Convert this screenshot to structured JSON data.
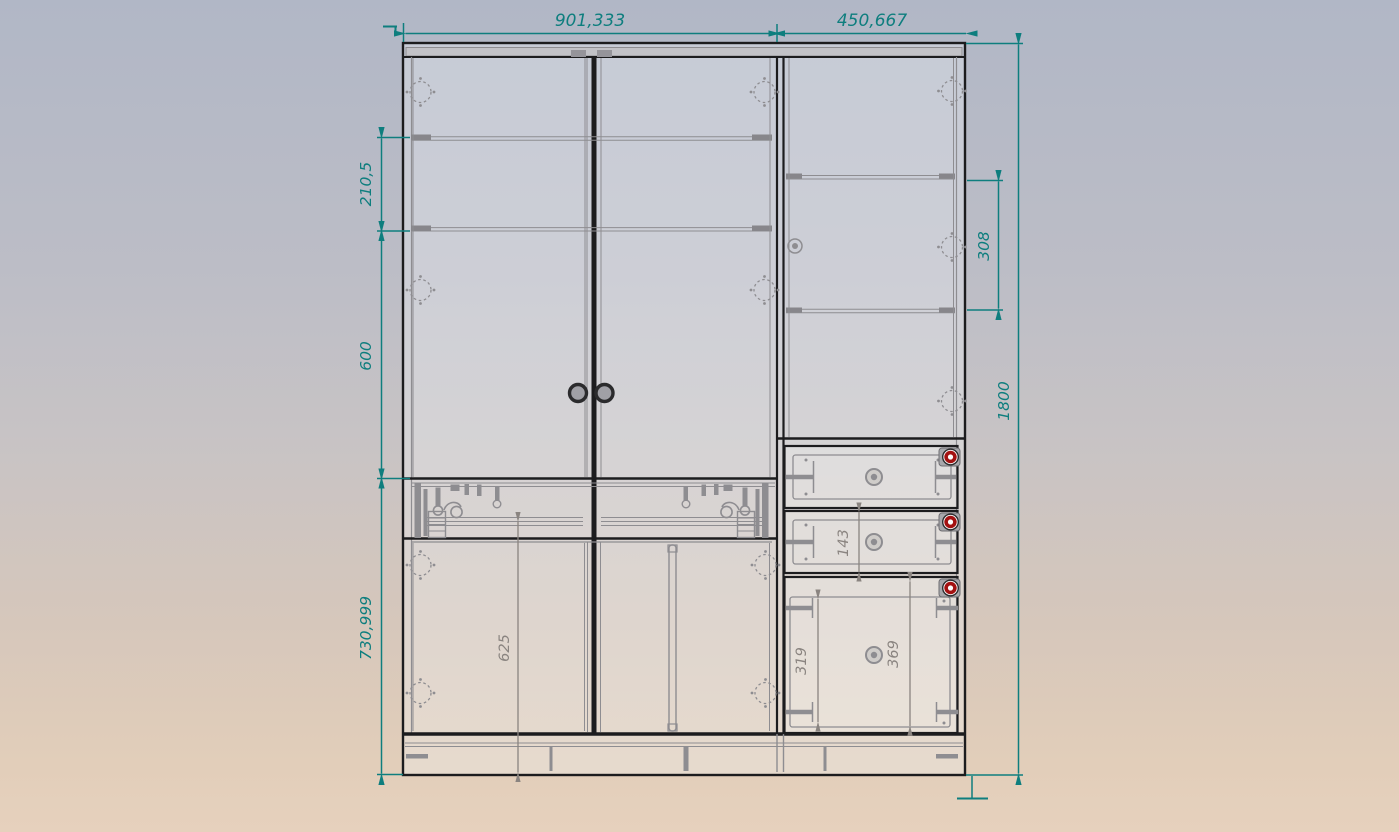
{
  "drawing": {
    "type": "furniture-front-elevation",
    "units": "mm",
    "dims": {
      "w_left": "901,333",
      "w_right": "450,667",
      "h_upper": "210,5",
      "h_middle": "600",
      "h_lower": "730,999",
      "shelf_gap": "308",
      "h_total": "1800",
      "door_625": "625",
      "drawer_143": "143",
      "panel_319": "319",
      "opening_369": "369"
    },
    "colors": {
      "dim_primary": "#0e7e7e",
      "dim_secondary": "#8a8480",
      "outline": "#1c1c1e",
      "hardware": "#8e8d91",
      "knob_red": "#a31111",
      "bg_top": "#b1b7c6",
      "bg_bottom": "#e6d1bd"
    }
  }
}
